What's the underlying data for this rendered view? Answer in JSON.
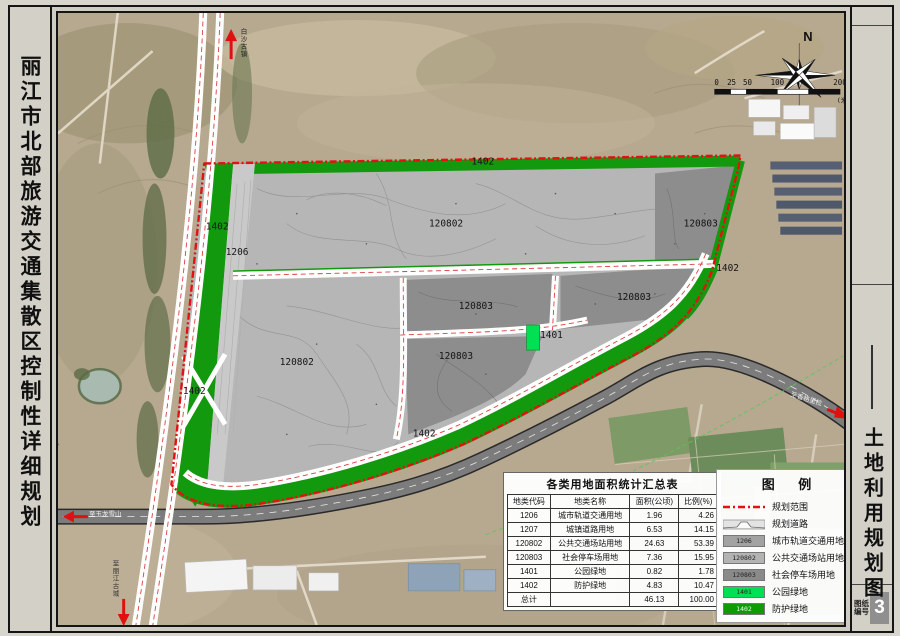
{
  "sheet": {
    "left_title": "丽江市北部旅游交通集散区控制性详细规划",
    "right_title": "土地利用规划图",
    "sheet_no_label_line1": "图纸",
    "sheet_no_label_line2": "编号",
    "sheet_number": "3"
  },
  "compass": {
    "north": "N"
  },
  "scale_bar": {
    "ticks": [
      "0",
      "25",
      "50",
      "100",
      "200"
    ],
    "unit": "(米)"
  },
  "map": {
    "parcel_labels": [
      "1402",
      "1402",
      "1206",
      "120802",
      "120803",
      "1402",
      "120803",
      "120803",
      "1401",
      "120803",
      "120802",
      "1402",
      "1402"
    ],
    "direction_labels": {
      "north": "白沙古镇",
      "west": "至玉龙雪山",
      "south": "至丽江古城",
      "east": "至香格里拉"
    }
  },
  "table": {
    "title": "各类用地面积统计汇总表",
    "headers": [
      "地类代码",
      "地类名称",
      "面积(公顷)",
      "比例(%)"
    ],
    "rows": [
      [
        "1206",
        "城市轨道交通用地",
        "1.96",
        "4.26"
      ],
      [
        "1207",
        "城镇道路用地",
        "6.53",
        "14.15"
      ],
      [
        "120802",
        "公共交通场站用地",
        "24.63",
        "53.39"
      ],
      [
        "120803",
        "社会停车场用地",
        "7.36",
        "15.95"
      ],
      [
        "1401",
        "公园绿地",
        "0.82",
        "1.78"
      ],
      [
        "1402",
        "防护绿地",
        "4.83",
        "10.47"
      ],
      [
        "总计",
        "",
        "46.13",
        "100.00"
      ]
    ]
  },
  "legend": {
    "title": "图 例",
    "items": [
      {
        "type": "boundary",
        "label": "规划范围"
      },
      {
        "type": "road",
        "label": "规划道路"
      },
      {
        "type": "swatch",
        "code": "1206",
        "label": "城市轨道交通用地",
        "color": "#a2a2a2"
      },
      {
        "type": "swatch",
        "code": "120802",
        "label": "公共交通场站用地",
        "color": "#b3b3b3"
      },
      {
        "type": "swatch",
        "code": "120803",
        "label": "社会停车场用地",
        "color": "#8a8a8a"
      },
      {
        "type": "swatch",
        "code": "1401",
        "label": "公园绿地",
        "color": "#00e052"
      },
      {
        "type": "swatch",
        "code": "1402",
        "label": "防护绿地",
        "color": "#0f9a06"
      }
    ]
  },
  "colors": {
    "boundary_red": "#e21212",
    "parcel_gray_light": "#b6b6b6",
    "parcel_gray_dark": "#8d8d8d",
    "park_green": "#00e052",
    "buffer_green": "#13990d",
    "highway_gray": "#7c7c7c"
  }
}
